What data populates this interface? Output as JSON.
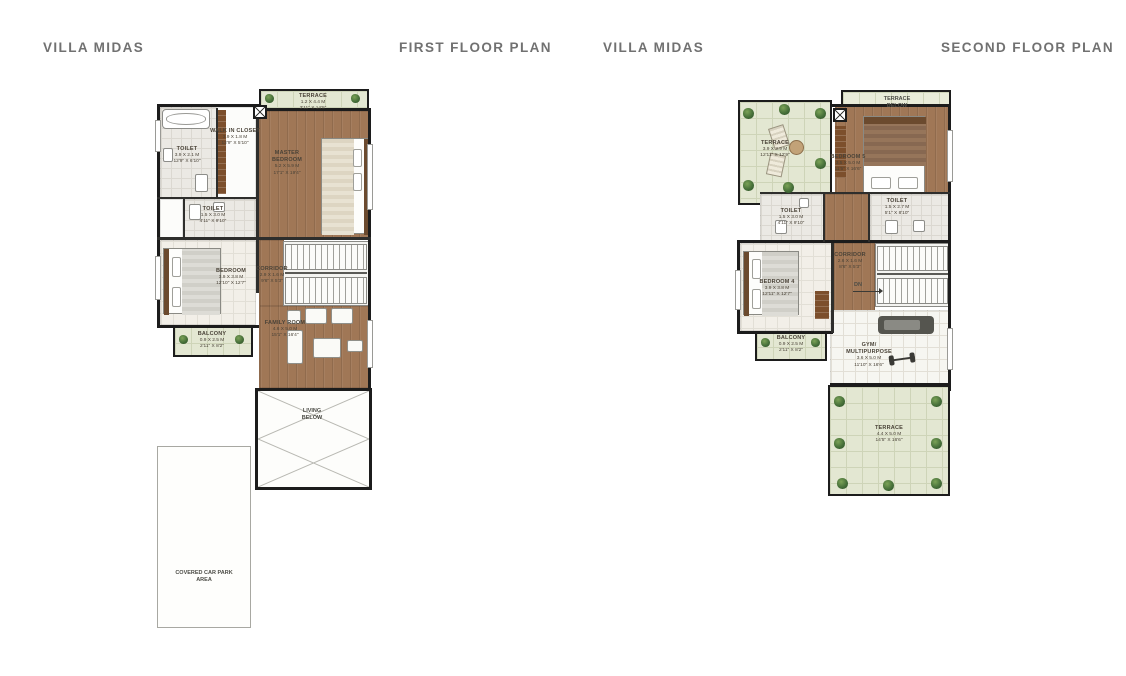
{
  "headers": {
    "left": {
      "title": "VILLA MIDAS",
      "plan": "FIRST FLOOR PLAN"
    },
    "right": {
      "title": "VILLA MIDAS",
      "plan": "SECOND FLOOR PLAN"
    }
  },
  "colors": {
    "header_text": "#717171",
    "wall": "#1c1c1c",
    "wood_floor": "#a07756",
    "terrace_green": "#e3e7d2",
    "tile": "#ebe9e4",
    "plant": "#47703a"
  },
  "first_floor": {
    "rooms": [
      {
        "name": "TERRACE",
        "dim_m": "1.2 X 4.4 M",
        "dim_ft": "3'11\" X 14'5\""
      },
      {
        "name": "WALK IN CLOSET",
        "dim_m": "3.9 X 1.8 M",
        "dim_ft": "12'9\" X 5'10\""
      },
      {
        "name": "TOILET",
        "dim_m": "3.9 X 2.1 M",
        "dim_ft": "12'9\" X 6'10\""
      },
      {
        "name": "MASTER BEDROOM",
        "dim_m": "5.2 X 5.9 M",
        "dim_ft": "17'1\" X 19'4\""
      },
      {
        "name": "TOILET",
        "dim_m": "1.5 X 3.0 M",
        "dim_ft": "4'11\" X 9'10\""
      },
      {
        "name": "BEDROOM",
        "dim_m": "3.9 X 3.8 M",
        "dim_ft": "12'10\" X 12'7\""
      },
      {
        "name": "CORRIDOR",
        "dim_m": "2.9 X 1.6 M",
        "dim_ft": "9'6\" X 5'3\""
      },
      {
        "name": "FAMILY ROOM",
        "dim_m": "4.6 X 5.0 M",
        "dim_ft": "15'1\" X 16'4\""
      },
      {
        "name": "BALCONY",
        "dim_m": "0.9 X 2.5 M",
        "dim_ft": "2'11\" X 8'2\""
      }
    ],
    "notes": {
      "living_below": "LIVING BELOW",
      "car_park": "COVERED CAR PARK AREA"
    }
  },
  "second_floor": {
    "rooms": [
      {
        "name": "TERRACE",
        "dim_m": "3.9 X 3.9 M",
        "dim_ft": "12'11\" X 12'9\""
      },
      {
        "name": "BEDROOM 5",
        "dim_m": "3.5 X 5.0 M",
        "dim_ft": "11'5\" X 16'6\""
      },
      {
        "name": "TOILET",
        "dim_m": "1.5 X 2.7 M",
        "dim_ft": "5'1\" X 8'10\""
      },
      {
        "name": "TOILET",
        "dim_m": "1.5 X 3.0 M",
        "dim_ft": "4'11\" X 9'10\""
      },
      {
        "name": "CORRIDOR",
        "dim_m": "2.6 X 1.6 M",
        "dim_ft": "8'6\" X 5'3\""
      },
      {
        "name": "BEDROOM 4",
        "dim_m": "3.9 X 3.8 M",
        "dim_ft": "12'11\" X 12'7\""
      },
      {
        "name": "BALCONY",
        "dim_m": "0.9 X 2.5 M",
        "dim_ft": "2'11\" X 8'2\""
      },
      {
        "name": "GYM/ MULTIPURPOSE",
        "dim_m": "3.6 X 5.0 M",
        "dim_ft": "11'10\" X 16'6\""
      },
      {
        "name": "TERRACE",
        "dim_m": "4.4 X 5.0 M",
        "dim_ft": "14'5\" X 16'6\""
      }
    ],
    "notes": {
      "terrace_below": "TERRACE BELOW",
      "dn": "DN"
    }
  }
}
